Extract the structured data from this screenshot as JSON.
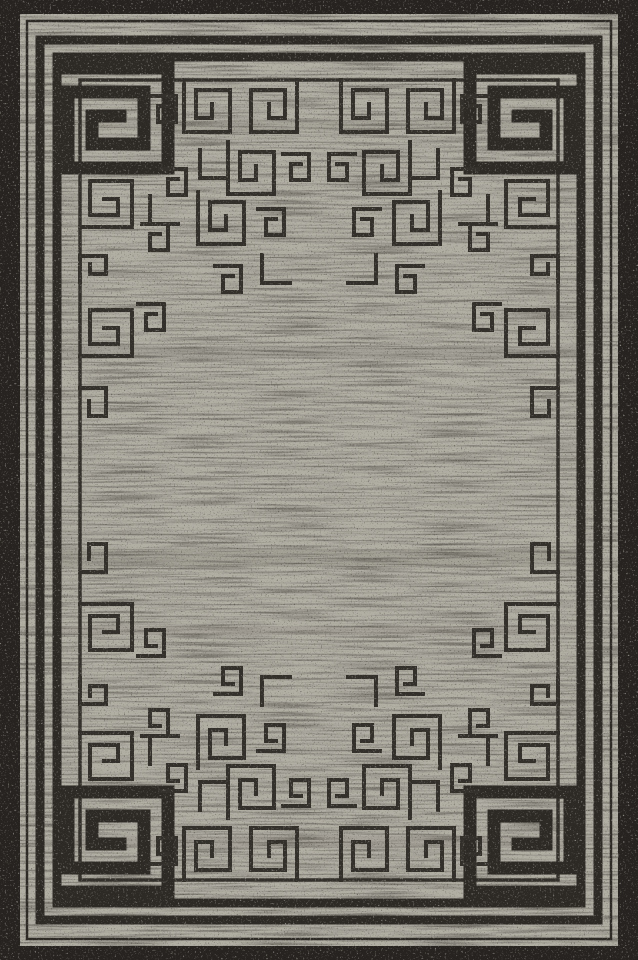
{
  "image": {
    "kind": "product-photo",
    "subject": "Rectangular area rug with Greek key meander pattern: black ornament on heathered gray field, black outer border, large spiral medallions in all four corners",
    "orientation": "portrait",
    "width_px": 638,
    "height_px": 960
  },
  "colors": {
    "background": "#262320",
    "field": "#b1aea4",
    "pattern": "#2d2a26",
    "pattern_thin": "#33302b",
    "streak": "#45423c",
    "speckle_dark": "#34312c",
    "speckle_light": "#b3b0a6",
    "wear_band": "#4e4b44"
  },
  "pattern_info": {
    "style": "greek-key",
    "corner_spiral_count": 4,
    "border_lines": [
      "thin outer pinstripe",
      "double thick black frame lines",
      "thin inner meander guideline with hook motifs"
    ],
    "field_texture": "distressed horizontal streaks with dark and light speckle",
    "symmetry": "mirrored in both axes"
  }
}
